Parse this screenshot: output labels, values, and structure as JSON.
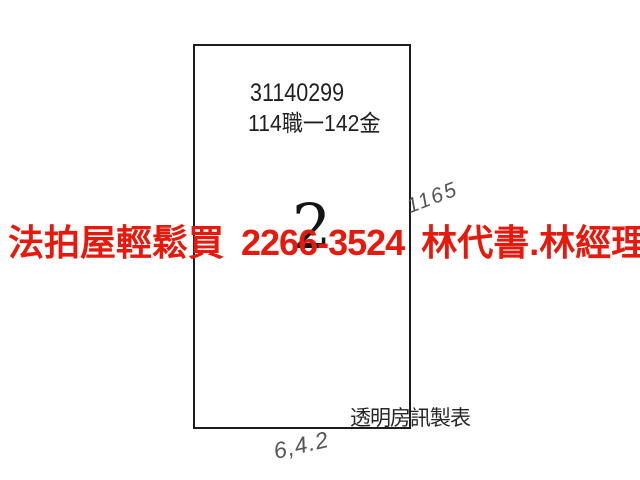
{
  "page": {
    "background_color": "#ffffff",
    "description_colors": {
      "outline_ink": "#1c1c1c",
      "watermark_red": "#e7190d",
      "pencil_gray": "#565656"
    }
  },
  "parcel_sheet": {
    "case_number": "31140299",
    "case_reference": "114職一142金",
    "lot_number": "2",
    "publisher_credit": "透明房訊製表"
  },
  "watermark_ad": {
    "agency": "法拍屋輕鬆買",
    "phone": "2266-3524",
    "contacts": "林代書.林經理",
    "color": "#e7190d"
  },
  "handwritten_notes": {
    "top_right": "1165",
    "bottom_center": "6,4.2"
  }
}
